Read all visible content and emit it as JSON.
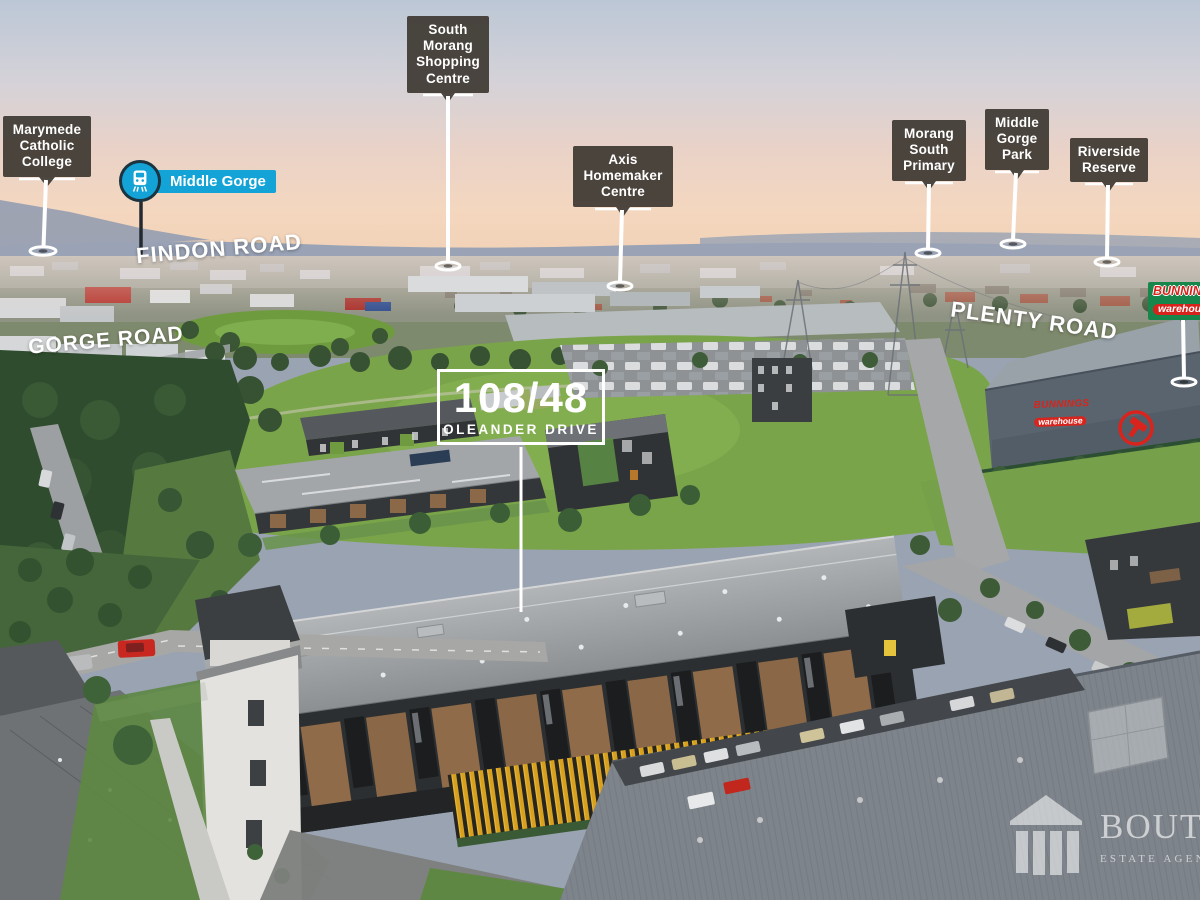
{
  "property_label": {
    "unit": "108/48",
    "street": "OLEANDER DRIVE"
  },
  "road_labels": {
    "findon": "FINDON ROAD",
    "gorge": "GORGE ROAD",
    "plenty": "PLENTY ROAD"
  },
  "poi_pins": {
    "marymede": "Marymede Catholic College",
    "south_morang": "South Morang Shopping Centre",
    "axis": "Axis Homemaker Centre",
    "morang_south": "Morang South Primary",
    "middle_gorge_park": "Middle Gorge Park",
    "riverside": "Riverside Reserve"
  },
  "train_station": {
    "name": "Middle Gorge"
  },
  "bunnings_sign": {
    "brand": "BUNNINGS",
    "sub_brand": "warehouse"
  },
  "bunnings_building_signage": {
    "brand": "BUNNINGS",
    "sub_brand": "warehouse"
  },
  "watermark": {
    "agency_name": "BOUTIQUE",
    "agency_type": "ESTATE AGENCY"
  },
  "colors": {
    "pin_box_bg": "#3e3933",
    "ptv_blue": "#14a3d6",
    "bunnings_green": "#17864a",
    "bunnings_red": "#d8231d",
    "fence_yellow": "#d7a01e",
    "sky_top": "#bcc7d6",
    "sunset_peach": "#f4d7bf",
    "field_green": "#7aa449"
  }
}
